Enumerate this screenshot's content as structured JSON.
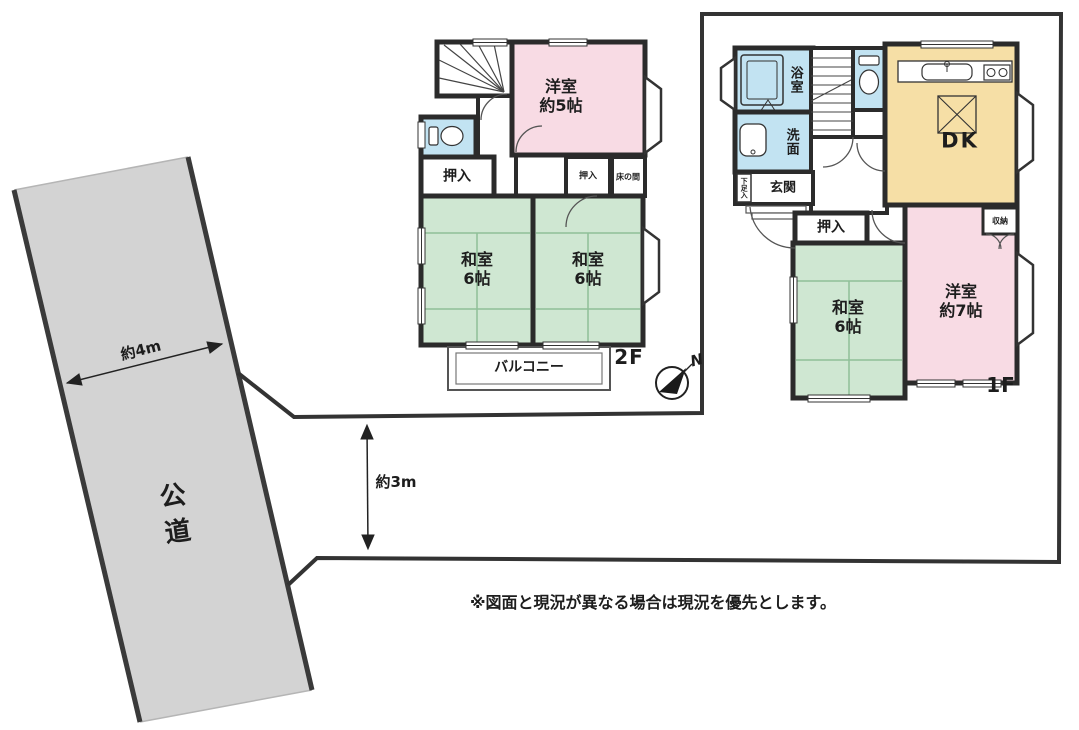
{
  "title": "間取り図",
  "road": {
    "label": "公道"
  },
  "dimensions": {
    "road_width": "約4m",
    "frontage": "約3m"
  },
  "floor2": {
    "floor_label": "2F",
    "rooms": {
      "western5": "洋室\n約5帖",
      "closet": "押入",
      "closet_small": "押入",
      "tokonoma": "床の間",
      "washitsu_left": "和室\n6帖",
      "washitsu_right": "和室\n6帖",
      "balcony": "バルコニー"
    }
  },
  "floor1": {
    "floor_label": "1F",
    "rooms": {
      "bath": "浴室",
      "washroom": "洗面",
      "entrance": "玄関",
      "shoe_cabinet": "下足入",
      "closet": "押入",
      "washitsu": "和室\n6帖",
      "western7": "洋室\n約7帖",
      "storage": "収納",
      "dining_kitchen": "DK"
    }
  },
  "compass": {
    "north_label": "N"
  },
  "note": "※図面と現況が異なる場合は現況を優先とします。",
  "colors": {
    "wall": "#2b2b2b",
    "boundary": "#333333",
    "road_fill": "#d3d3d3",
    "tatami_room_fill": "#cfe7d2",
    "western_room_fill": "#f8dbe4",
    "wet_area_fill": "#c2e3f2",
    "dk_fill": "#f6dfa6"
  }
}
